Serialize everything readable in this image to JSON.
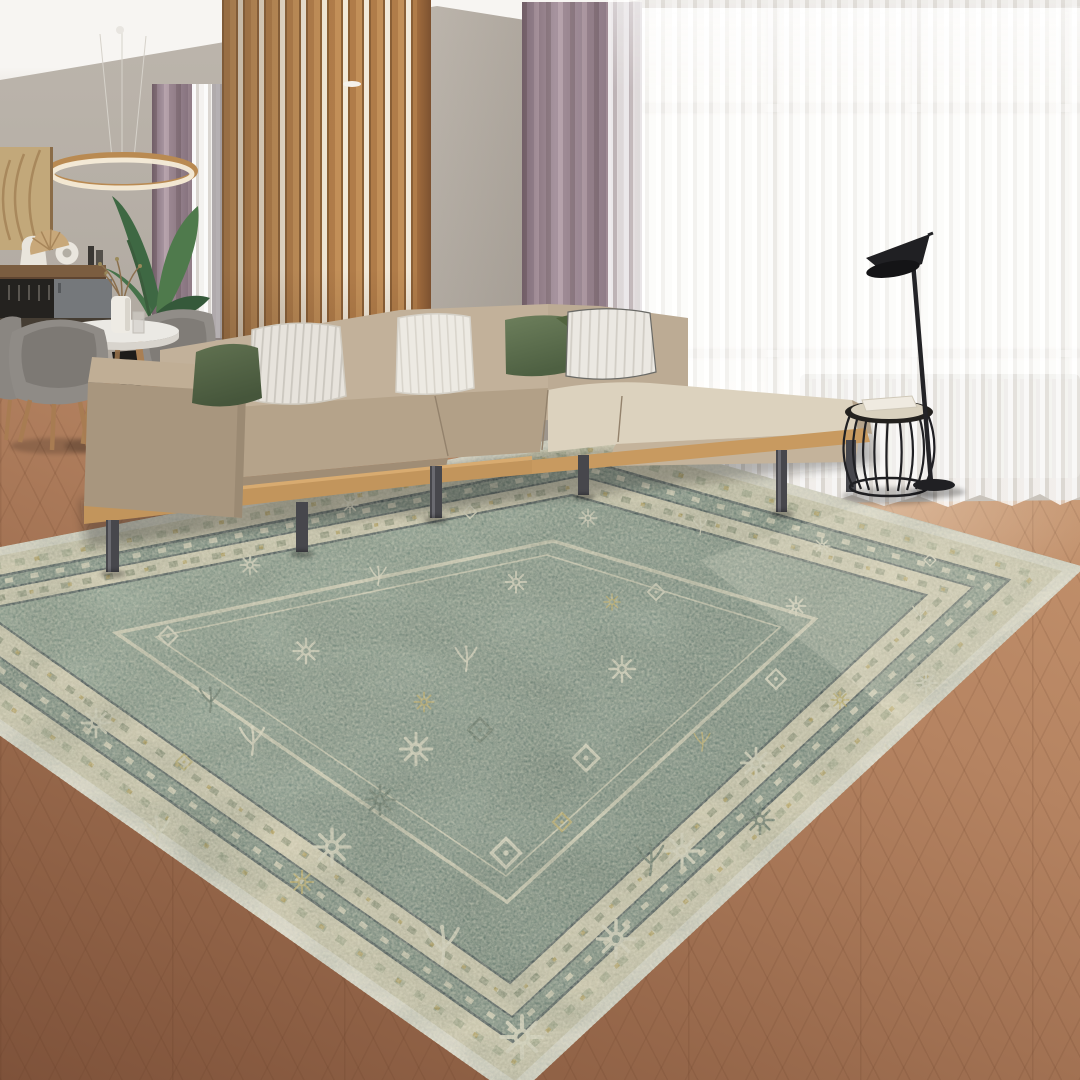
{
  "image": {
    "kind": "interior product photograph",
    "width_px": 1080,
    "height_px": 1080
  },
  "scene": {
    "type": "staged living-room photo (no text, no UI widgets)",
    "subject": "large vintage-style distressed area rug, teal-green field with cream floral motifs, layered cream borders, navy guard stripes, gold accents and white fringe binding",
    "lighting": "bright daylight from large sheer-covered window on the right",
    "objects": [
      {
        "name": "area-rug",
        "note": "teal/green Heriz-style rug, allover cream florals, cream ornate borders, thin navy guards, white fringe edge, laid diagonally"
      },
      {
        "name": "sectional-sofa",
        "note": "L-shaped beige fabric sofa on light oak platform base with dark metal cylinder legs"
      },
      {
        "name": "chaise-cushion",
        "note": "light cream bench cushion on right wing of sectional"
      },
      {
        "name": "throw-pillows",
        "note": "5 pillows: dark green, white ticking-stripe, ivory stripe, sage green, grey pinstripe"
      },
      {
        "name": "wood-slat-partition",
        "note": "vertical oak slat screen behind sofa, backlit gaps"
      },
      {
        "name": "drapes",
        "note": "mauve/taupe pleated curtains at both windows"
      },
      {
        "name": "sheer-curtain",
        "note": "floor-length white voile across the right window"
      },
      {
        "name": "window",
        "note": "large bright window with white frame and mullions"
      },
      {
        "name": "radiator",
        "note": "white panel radiator under window, seen through sheer"
      },
      {
        "name": "floor-lamp",
        "note": "black AJ-style floor lamp with angled conical shade"
      },
      {
        "name": "wire-side-table",
        "note": "black wire cage drum stool with cream tray top and white book"
      },
      {
        "name": "dining-set",
        "note": "round white table, grey tub chairs with oak legs, dark object beneath"
      },
      {
        "name": "pendant-ring-light",
        "note": "brass/white LED ring chandelier over dining table"
      },
      {
        "name": "potted-plant",
        "note": "tall banana-leaf plant behind dining table; twig sprigs in white vase on table"
      },
      {
        "name": "wall-art",
        "note": "tan carved-texture panel artwork on left wall"
      },
      {
        "name": "sideboard-shelf",
        "note": "wood shelf with white jug, ring sculpture, paper fan, bottles; hanging wine glasses and grey cabinet below"
      },
      {
        "name": "floor",
        "note": "warm brown herringbone/chevron hardwood, lighter near window"
      },
      {
        "name": "ceiling",
        "note": "plain white ceiling visible top-left"
      }
    ]
  },
  "palette": {
    "ceiling": "#f7f5f2",
    "wall": "#bdb6ad",
    "slat": "#b07c49",
    "slat_dark": "#8a5f36",
    "slat_gap": "#f2e9d9",
    "drape": "#9c8793",
    "drape_dark": "#857079",
    "drape_light": "#b09aa4",
    "window": "#fdfcfa",
    "radiator": "#d9d6d1",
    "floor_light": "#c99871",
    "floor_mid": "#96674a",
    "floor_dark": "#7e523a",
    "sofa_beige": "#b5a38a",
    "sofa_front": "#a08d75",
    "sofa_back": "#c2b19a",
    "cushion_cream": "#dcd2be",
    "platform_wood": "#c2955c",
    "leg_metal": "#47474c",
    "pillow_white": "#e7e3dc",
    "pillow_green": "#5a6c4d",
    "rug_fringe": "#ece8db",
    "rug_border_cream": "#d8d1b6",
    "rug_navy": "#3f4d52",
    "rug_margin_green": "#788c81",
    "rug_field": "#74897e",
    "rug_motif": "#e8e3cd",
    "rug_gold": "#c1ae62",
    "chair_gray": "#8e8a85",
    "chair_wood": "#a87c52",
    "table_white": "#ebe9e4",
    "plant_green": "#3e6843",
    "lamp_black": "#202023",
    "decor_tan": "#c2a87a"
  }
}
